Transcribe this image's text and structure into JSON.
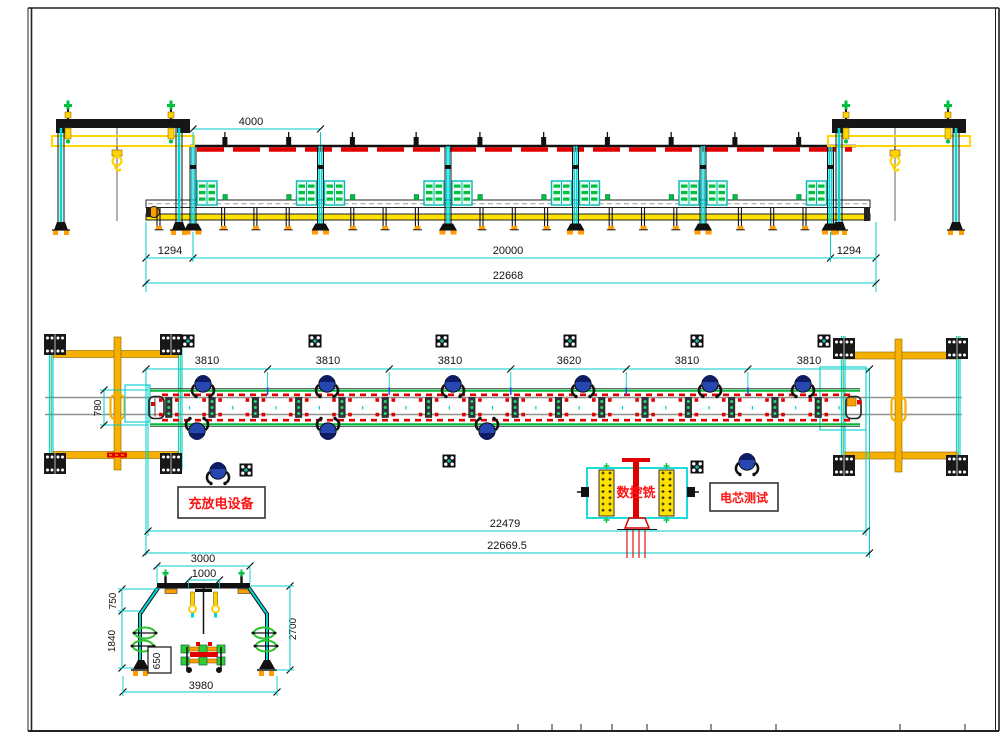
{
  "colors": {
    "cyan": "#00d8d8",
    "dim": "#00cccc",
    "yellow": "#ffe100",
    "gold": "#ffd400",
    "orange": "#ff9e00",
    "plan_gold": "#f6b100",
    "green": "#00b83c",
    "cabinet_green": "#00c040",
    "red": "#e00000",
    "label_red": "#ff1212",
    "operator_blue": "#2747b0",
    "rail_gray": "#909090",
    "black": "#161616"
  },
  "elevation_view": {
    "dim_bay": "4000",
    "dim_left_overhang": "1294",
    "dim_span": "20000",
    "dim_right_overhang": "1294",
    "dim_total": "22668"
  },
  "plan_view": {
    "dims_top": [
      "3810",
      "3810",
      "3810",
      "3620",
      "3810",
      "3810"
    ],
    "dim_conveyor_width": "780",
    "dim_inner_total": "22479",
    "dim_outer_total": "22669.5",
    "labels": {
      "charge": "充放电设备",
      "cnc": "数控铣",
      "test": "电芯测试"
    }
  },
  "end_view": {
    "dim_top_outer": "3000",
    "dim_top_inner": "1000",
    "dim_upper_left": "750",
    "dim_lower_left": "1840",
    "dim_cart": "650",
    "dim_right_height": "2700",
    "dim_bottom": "3980"
  }
}
